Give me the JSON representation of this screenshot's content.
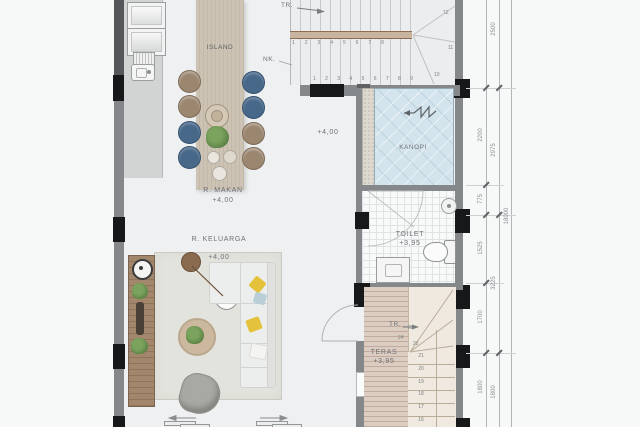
{
  "labels": {
    "island": "ISLAND",
    "tr_top": "TR.",
    "nk": "NK.",
    "hall_level": "+4,00",
    "kanopi": "KANOPI",
    "r_makan": {
      "name": "R. MAKAN",
      "level": "+4,00"
    },
    "toilet": {
      "name": "TOILET",
      "level": "+3,95"
    },
    "r_keluarga": {
      "name": "R. KELUARGA",
      "level": "+4,00"
    },
    "teras": {
      "name": "TERAS",
      "level": "+3,95"
    },
    "tr_bottom": "TR."
  },
  "stairs_top": {
    "upper_run_numbers": [
      "1",
      "2",
      "3",
      "4",
      "5",
      "6",
      "7",
      "8"
    ],
    "lower_run_numbers": [
      "1",
      "2",
      "3",
      "4",
      "5",
      "6",
      "7",
      "8",
      "9"
    ],
    "winder_numbers": {
      "n10": "10",
      "n11": "11",
      "n12": "12"
    }
  },
  "stairs_bottom": {
    "straight_numbers": [
      "21",
      "20",
      "19",
      "18",
      "17",
      "16"
    ],
    "winder_numbers": {
      "n22": "22",
      "n23": "23",
      "n24": "24"
    }
  },
  "dimensions": {
    "inner_chain": {
      "d2200": "2200",
      "d775": "775",
      "d1525": "1525",
      "d1700": "1700",
      "d1800": "1800"
    },
    "outer_chain": {
      "d2500": "2500",
      "d2975": "2975",
      "d3225": "3225",
      "d1800": "1800"
    },
    "overall": "18000"
  },
  "colors": {
    "wall": "#85888b",
    "column": "#17181a",
    "wood_island": "#cdc3b4",
    "deck_teras": "#dccdc2",
    "glass_canopy": "#d3e4ec",
    "chair_brown": "#9b8670",
    "chair_blue": "#48688a",
    "pillow_yellow": "#e5c23c",
    "pillow_blue": "#b8cfd8",
    "stairs_bottom": "#efe9df",
    "floor": "#eef0f1"
  }
}
